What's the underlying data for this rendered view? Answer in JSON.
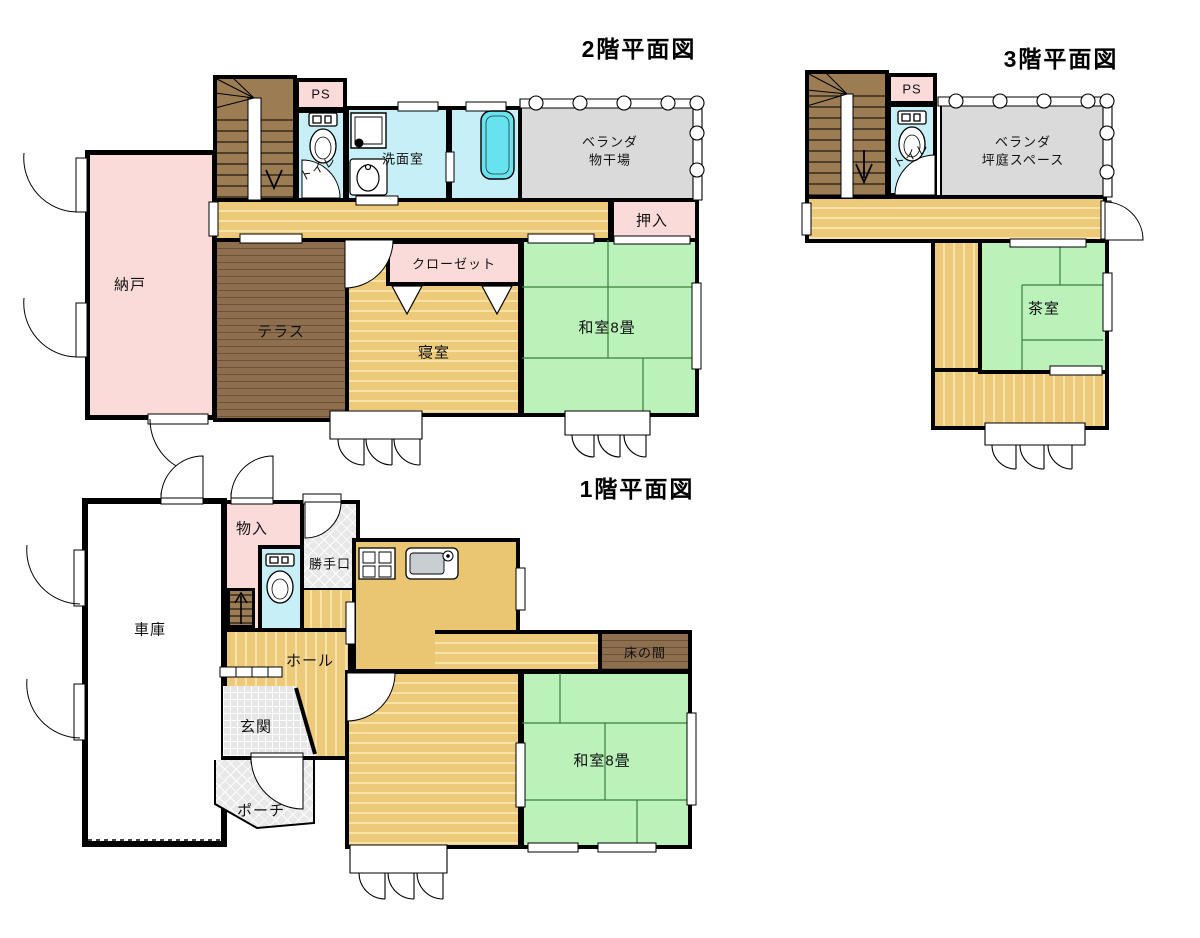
{
  "colors": {
    "wall": "#000000",
    "wood_floor": "#ecca79",
    "wood_stripe": "#f7e2a9",
    "tatami_green": "#baf2ba",
    "tatami_line": "#3f7f3f",
    "pink_room": "#fbdada",
    "water_room": "#c6eff7",
    "bathtub": "#66e3ef",
    "veranda_gray": "#dadada",
    "stair_brown": "#9b7c53",
    "terrace_brown": "#8d6e4e",
    "hatch_gray": "#e6e6e6"
  },
  "titles": {
    "f2": "2階平面図",
    "f3": "3階平面図",
    "f1": "1階平面図"
  },
  "f2": {
    "ps": "PS",
    "toilet": "トイレ",
    "washroom": "洗面室",
    "veranda_line1": "ベランダ",
    "veranda_line2": "物干場",
    "oshiire": "押入",
    "nando": "納戸",
    "terrace": "テラス",
    "closet": "クローゼット",
    "bedroom": "寝室",
    "washitsu": "和室8畳"
  },
  "f3": {
    "ps": "PS",
    "toilet": "トイレ",
    "veranda_line1": "ベランダ",
    "veranda_line2": "坪庭スペース",
    "tearoom": "茶室"
  },
  "f1": {
    "monoire": "物入",
    "katteguchi": "勝手口",
    "garage": "車庫",
    "hall": "ホール",
    "genkan": "玄関",
    "porch": "ポーチ",
    "tokonoma": "床の間",
    "washitsu": "和室8畳"
  },
  "icons": {
    "toilet": "toilet-icon",
    "washing_machine": "washing-machine-icon",
    "vanity_sink": "sink-icon",
    "bathtub": "bathtub-icon",
    "stove": "stove-icon",
    "kitchen_sink": "kitchen-sink-icon",
    "stair_arrow": "stairs-direction-arrow-icon",
    "veranda_railing": "railing-icon"
  }
}
